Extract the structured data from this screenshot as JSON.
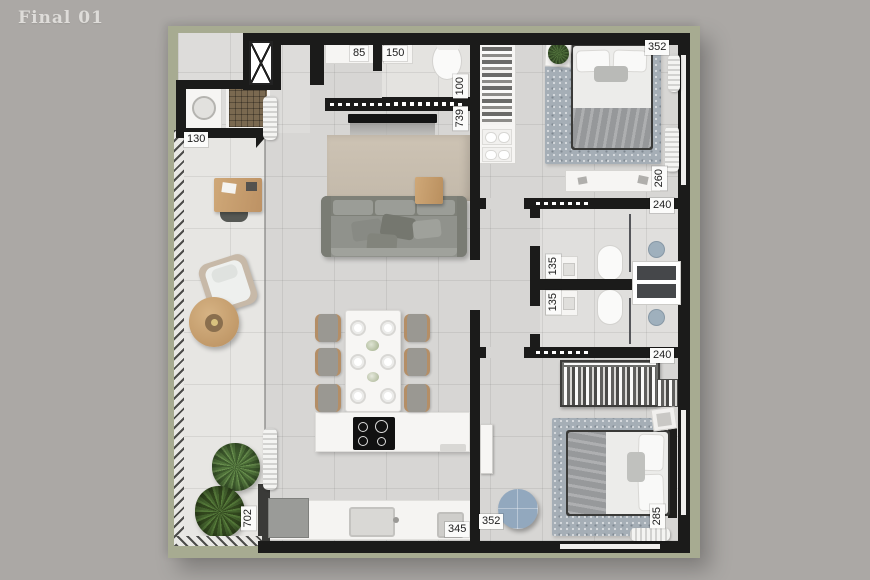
{
  "title": "Final 01",
  "palette": {
    "page_bg": "#aba8a5",
    "mat_green": "#a7ab91",
    "wall_black": "#1b1b1a",
    "floor_gray": "#d7d6d4",
    "balcony_floor": "#e7e6e3",
    "feature_wall_tan": "#c8beaf",
    "wood": "#c79f6e",
    "sofa_gray": "#8e908a",
    "rug_blue_gray": "#a5aeb6",
    "pouf_blue": "#92a8be",
    "plant_green": "#55793f",
    "shower_tile_brown": "#7a6950",
    "fixture_white": "#f6f5f3"
  },
  "dimensions": {
    "labels": [
      {
        "id": "service-width",
        "text": "130",
        "axis": "h"
      },
      {
        "id": "entry-cabinet-width",
        "text": "85",
        "axis": "h"
      },
      {
        "id": "wc-width",
        "text": "150",
        "axis": "h"
      },
      {
        "id": "wc-wall-length",
        "text": "100",
        "axis": "v"
      },
      {
        "id": "living-wall-length",
        "text": "739",
        "axis": "v"
      },
      {
        "id": "bedroom1-width",
        "text": "352",
        "axis": "h"
      },
      {
        "id": "bedroom1-dresser-length",
        "text": "260",
        "axis": "v"
      },
      {
        "id": "bathroom1-width",
        "text": "240",
        "axis": "h"
      },
      {
        "id": "vanity1-width",
        "text": "135",
        "axis": "v"
      },
      {
        "id": "vanity2-width",
        "text": "135",
        "axis": "v"
      },
      {
        "id": "bathroom2-width",
        "text": "240",
        "axis": "h"
      },
      {
        "id": "kitchen-counter-length",
        "text": "345",
        "axis": "h"
      },
      {
        "id": "kitchen-width",
        "text": "352",
        "axis": "h"
      },
      {
        "id": "balcony-length",
        "text": "702",
        "axis": "v"
      },
      {
        "id": "bedroom2-width",
        "text": "285",
        "axis": "v"
      }
    ]
  }
}
